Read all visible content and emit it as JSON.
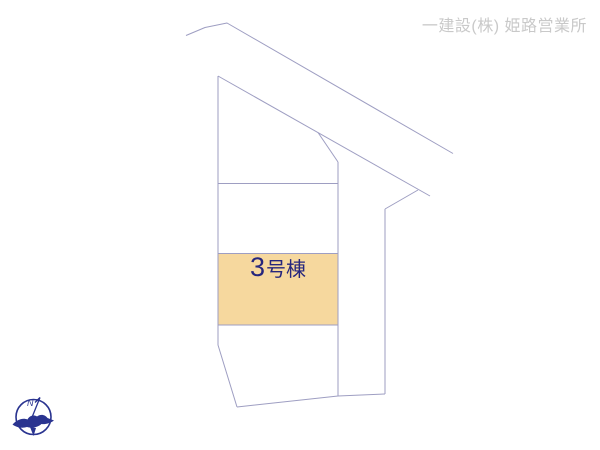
{
  "page": {
    "background": "#ffffff",
    "width": 600,
    "height": 450
  },
  "header": {
    "company_label": "一建設(株) 姫路営業所",
    "color": "#c9c9c9"
  },
  "plan": {
    "line_color": "#9e9ec2",
    "highlight_plot": {
      "label_number": "3",
      "label_suffix": "号棟",
      "label_full": "3号棟",
      "fill": "#f6d89e",
      "text_color": "#26267d",
      "x": 218,
      "y": 253.5,
      "width": 120,
      "height": 71.5
    },
    "polylines": [
      {
        "name": "road-upper-edge",
        "points": [
          [
            186,
            35.5
          ],
          [
            205,
            27.5
          ],
          [
            227,
            23
          ],
          [
            453,
            153.5
          ]
        ]
      },
      {
        "name": "road-inner-edge",
        "points": [
          [
            218,
            76
          ],
          [
            430,
            196
          ]
        ]
      },
      {
        "name": "plot-corner-cut-west",
        "points": [
          [
            318,
            132.5
          ],
          [
            338,
            162
          ]
        ]
      },
      {
        "name": "plot-corner-cut-east",
        "points": [
          [
            418,
            190
          ],
          [
            385,
            209
          ]
        ]
      },
      {
        "name": "west-boundary",
        "points": [
          [
            218,
            76
          ],
          [
            218,
            345
          ],
          [
            237,
            407
          ]
        ]
      },
      {
        "name": "south-boundary",
        "points": [
          [
            237,
            407
          ],
          [
            338,
            396
          ],
          [
            385,
            394
          ]
        ]
      },
      {
        "name": "divider-north",
        "points": [
          [
            218,
            183.5
          ],
          [
            338,
            183.5
          ]
        ]
      },
      {
        "name": "mid-vertical",
        "points": [
          [
            338,
            162
          ],
          [
            338,
            396
          ]
        ]
      },
      {
        "name": "east-vertical",
        "points": [
          [
            385,
            209
          ],
          [
            385,
            394
          ]
        ]
      }
    ]
  },
  "compass": {
    "label": "N",
    "color": "#2a3490"
  }
}
